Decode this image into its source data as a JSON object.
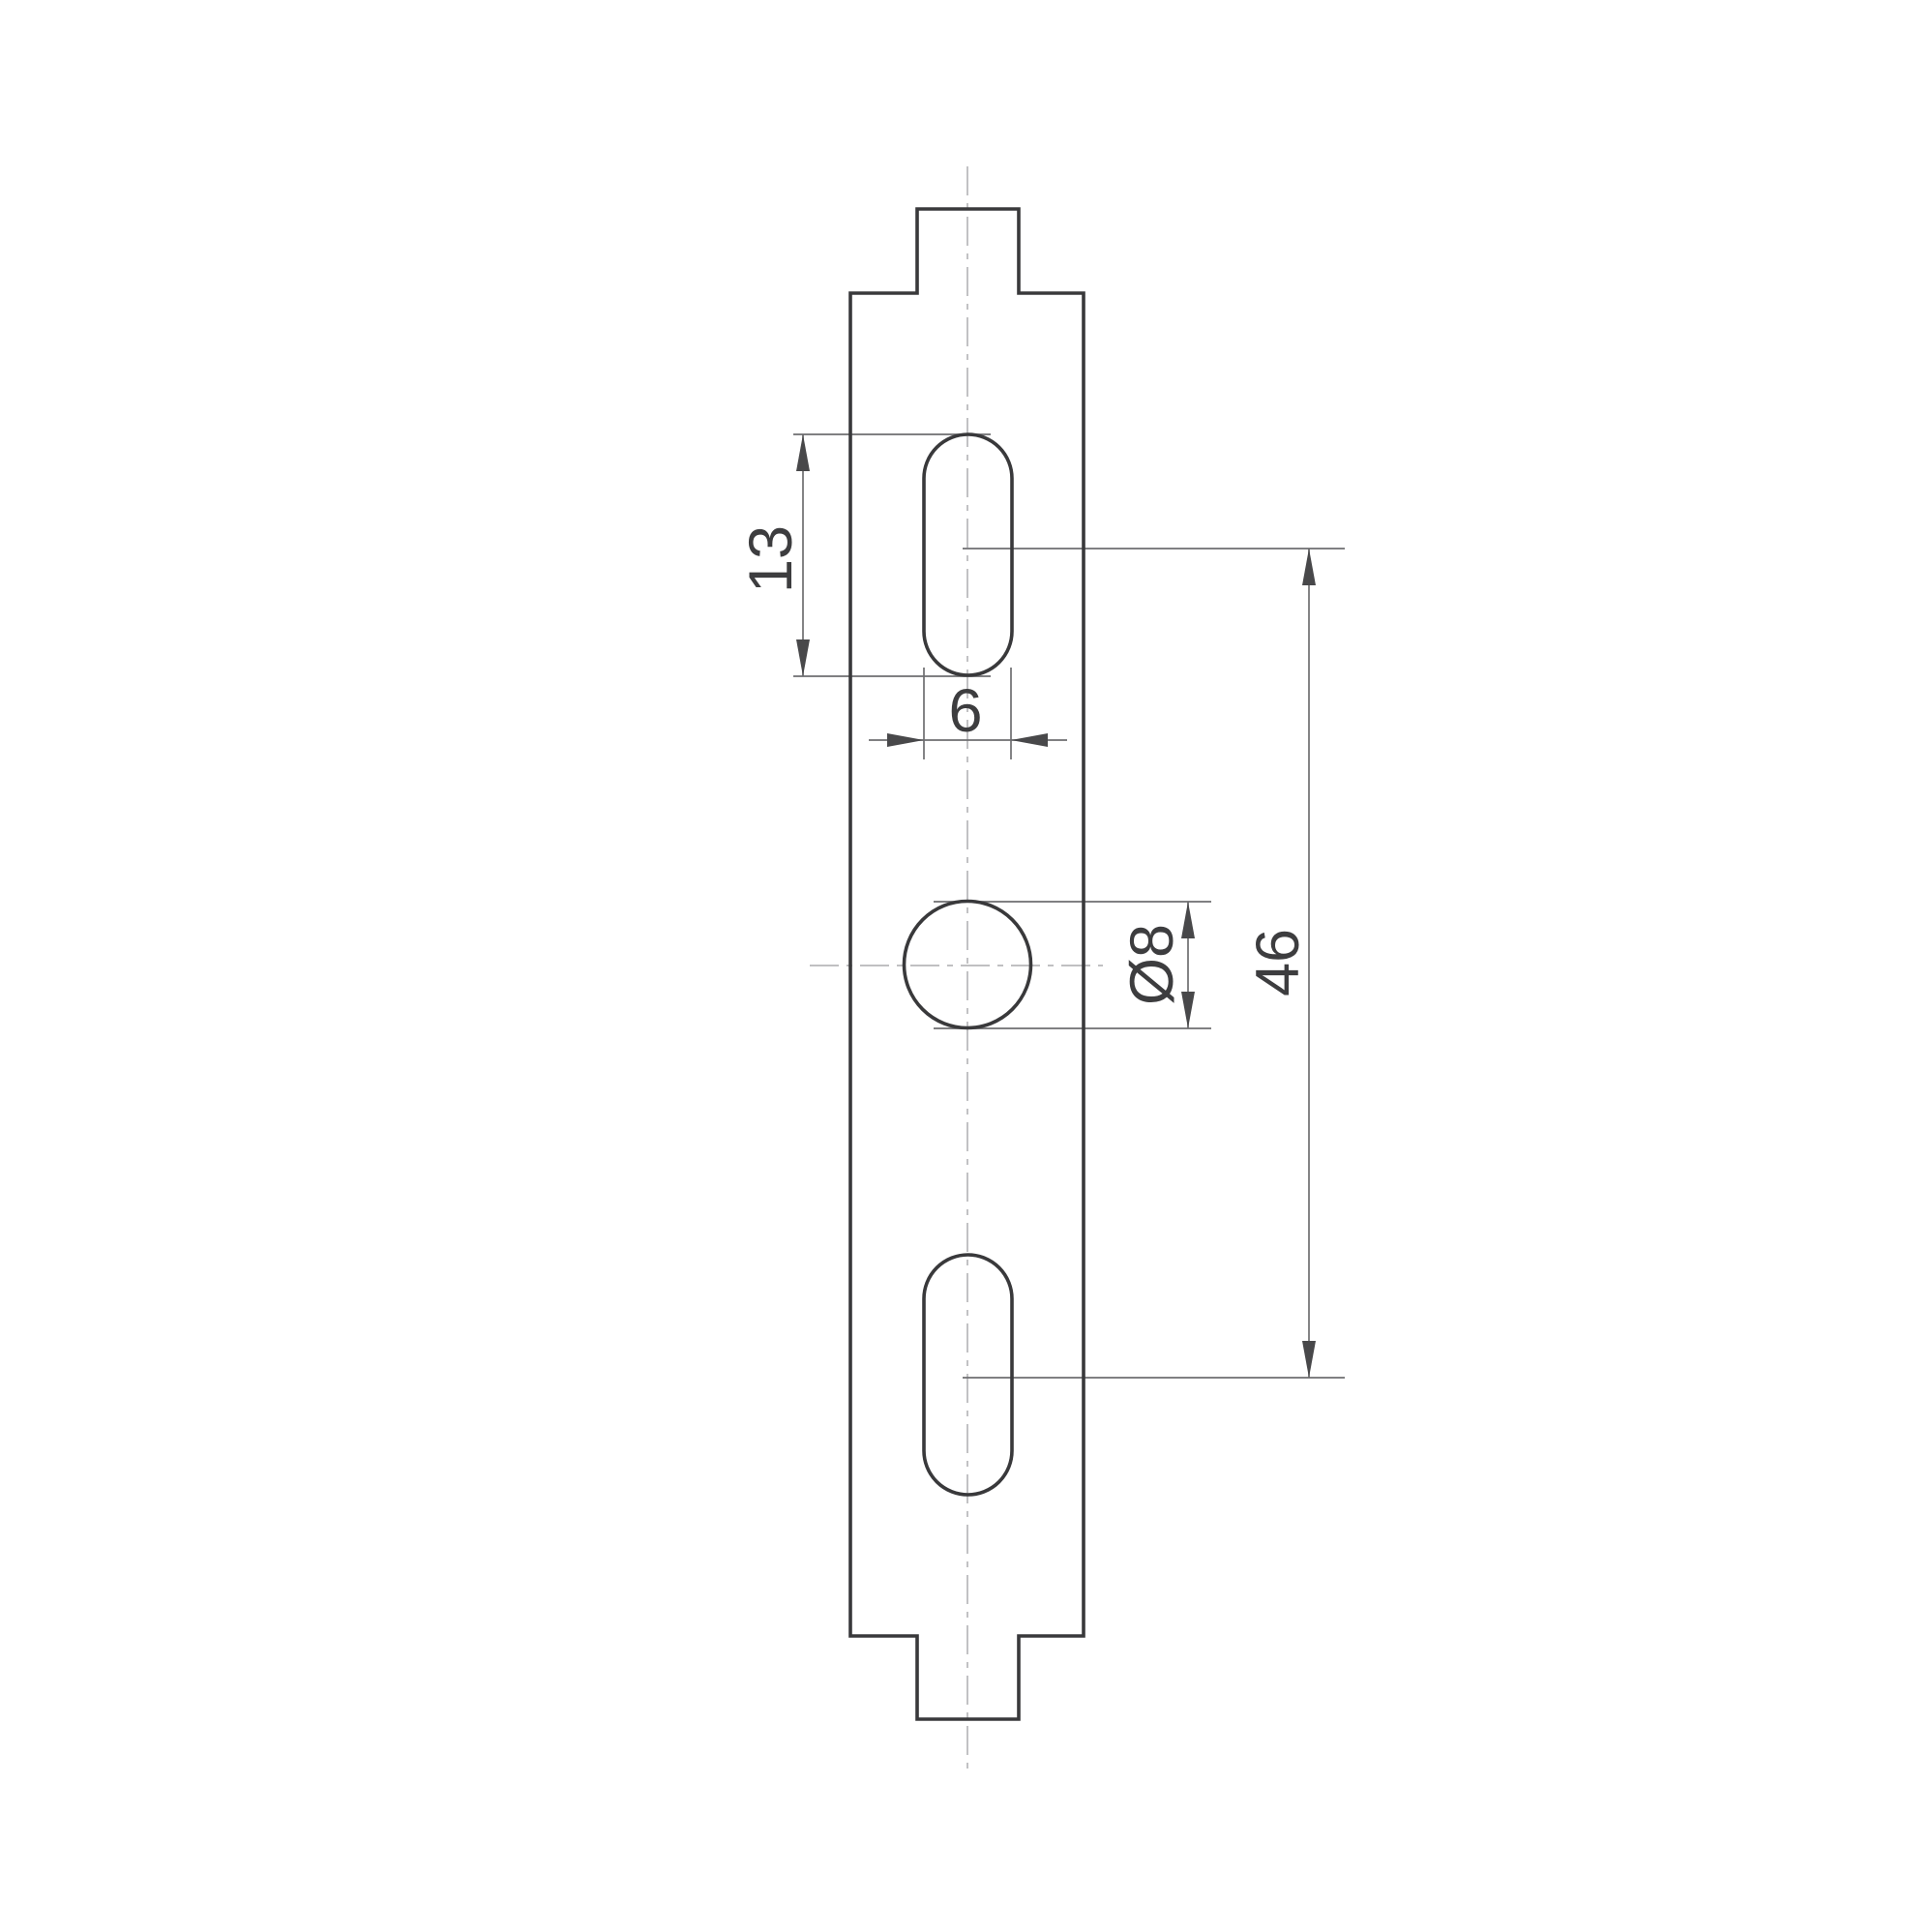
{
  "drawing": {
    "type": "technical-drawing-mounting-plate",
    "background": "#ffffff",
    "colors": {
      "outline": "#39393b",
      "dimension": "#6e6e70",
      "arrow": "#48484a",
      "centerline": "#b8b8ba",
      "text": "#3d3d3f"
    },
    "labels": {
      "slot_length": "13",
      "slot_width": "6",
      "hole_diameter": "Ø8",
      "slot_spacing": "46"
    }
  }
}
